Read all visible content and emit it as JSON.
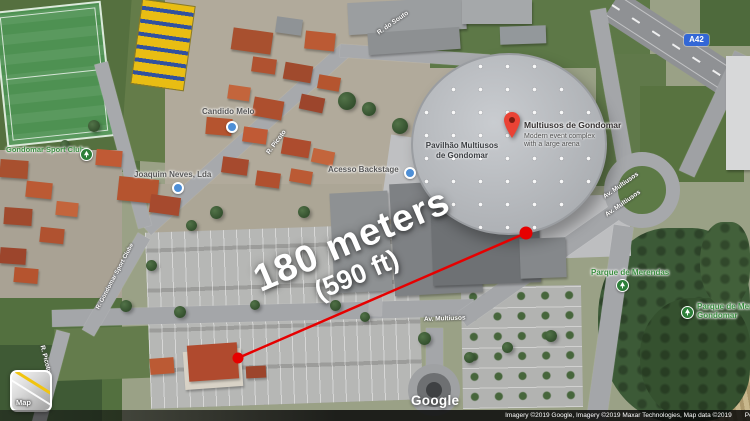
{
  "colors": {
    "accent": "#e60000",
    "pin": "#ea4335",
    "park": "#3c8f42",
    "poi": "#565656",
    "shield-bg": "#3367d6"
  },
  "annotation": {
    "distance": "180 meters",
    "distance_alt": "(590 ft)"
  },
  "marker": {
    "title": "Multiusos de Gondomar",
    "subtitle1": "Modern event complex",
    "subtitle2": "with a large arena"
  },
  "arena": {
    "label1": "Pavilhão Multiusos",
    "label2": "de Gondomar"
  },
  "pois": [
    {
      "label": "Gondomar Sport Clube"
    },
    {
      "label": "Candido Melo"
    },
    {
      "label": "Joaquim Neves, Lda"
    },
    {
      "label": "Acesso Backstage"
    },
    {
      "label": "Parque de Merendas"
    },
    {
      "label1": "Parque de Merendas",
      "label2": "Gondomar"
    }
  ],
  "roads": {
    "picoto": "R. Picoto",
    "picoto2": "R. Picoto",
    "souto": "R. do Souto",
    "gondomar_sc": "R. Gondomar Sport Clube",
    "multiusos_a": "Av. Multiusos",
    "multiusos_b": "Av. Multiusos",
    "multiusos_c": "Av. Multiusos",
    "shield": "A42"
  },
  "controls": {
    "map_toggle": "Map"
  },
  "watermark": "Google",
  "attribution": {
    "line": "Imagery ©2019 Google, Imagery ©2019 Maxar Technologies, Map data ©2019",
    "region": "Portugal"
  }
}
